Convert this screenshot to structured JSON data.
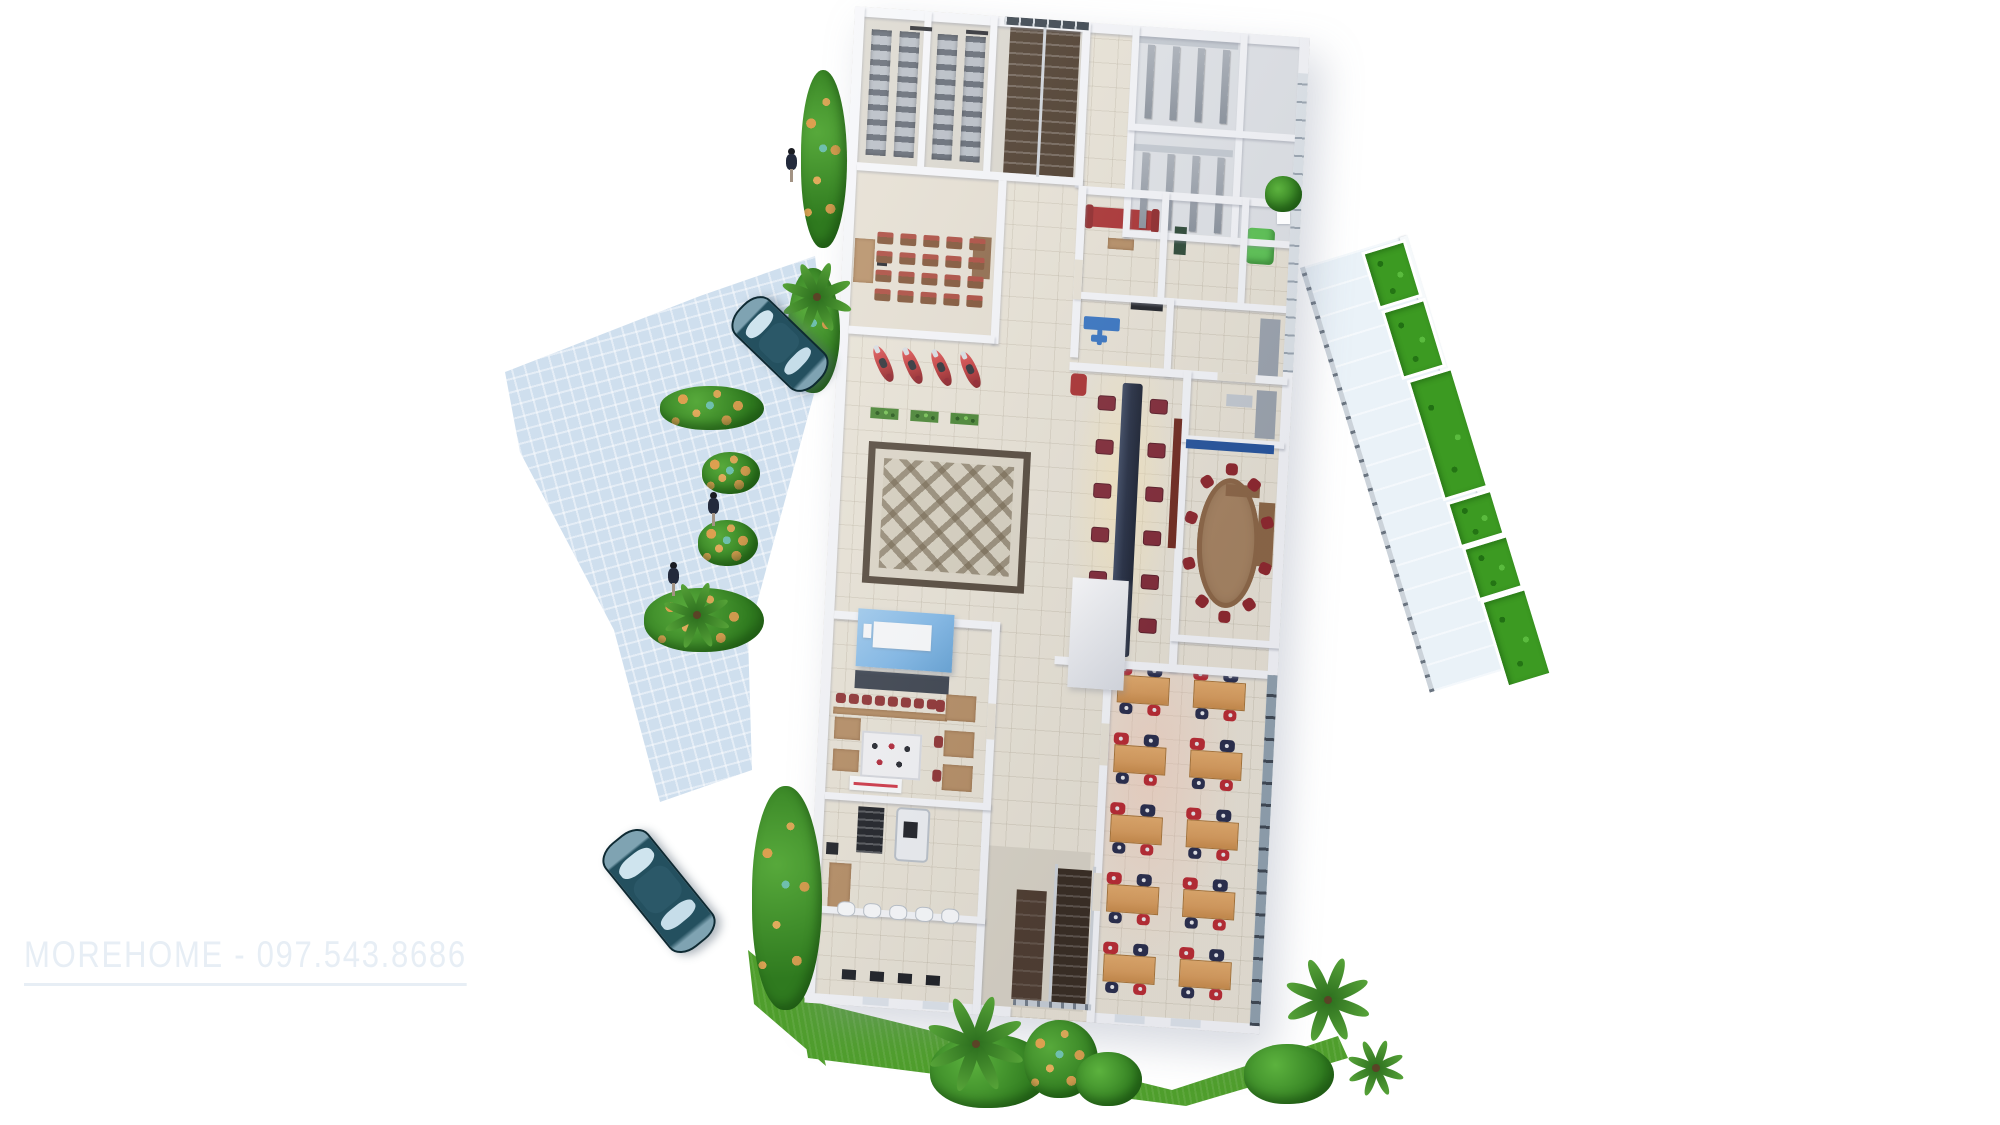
{
  "meta": {
    "type": "3d-floorplan-render",
    "view": "axonometric-top-down",
    "background": "#ffffff"
  },
  "watermark": {
    "text": "MOREHOME - 097.543.8686"
  },
  "scene": {
    "description": "3D cutaway render of an office / showroom building ground floor with driveway, cars, motorbikes, landscaping",
    "people_count": 3,
    "vehicles": {
      "cars": 2,
      "motorbikes": 4
    },
    "rooms": [
      "storage",
      "stairwell",
      "restrooms",
      "training-room",
      "lounge",
      "office",
      "reception",
      "meeting-room",
      "cafe",
      "gym",
      "showroom",
      "entrance",
      "terrace"
    ]
  },
  "counts": {
    "training_chair_cols": 5,
    "training_chair_rows": 4,
    "reception_chairs_per_side": 6,
    "showroom_desk_cols": 2,
    "showroom_desk_rows": 5,
    "conference_chairs": 10,
    "cafe_bar_chairs": 8,
    "terrace_planters": 6,
    "toilet_stalls_per_block": 4,
    "shelf_units": 4,
    "plant_boxes": 3,
    "bottom_window_slots": 4,
    "sanitary_fixtures": 5,
    "floor_dots": 4,
    "palm_fronds": 8
  },
  "colors": {
    "paving": "#cfdfee",
    "floor": "#e9e3d5",
    "wall": "#f6f7fa",
    "grass": "#4f9e2c",
    "planter": "#3c9a22",
    "stair_wood": "#42301f",
    "counter_navy": "#20293e",
    "chair_red": "#8c2b2b",
    "desk_orange": "#d89a58",
    "sofa_red": "#a82828",
    "canopy_blue": "#7db7e8",
    "car_teal": "#1d4a5e",
    "motorbike_red": "#c03232",
    "accent_blue_wall": "#1f4f9a",
    "tv_maroon": "#6e2418",
    "watermark": "#e7eef5"
  }
}
